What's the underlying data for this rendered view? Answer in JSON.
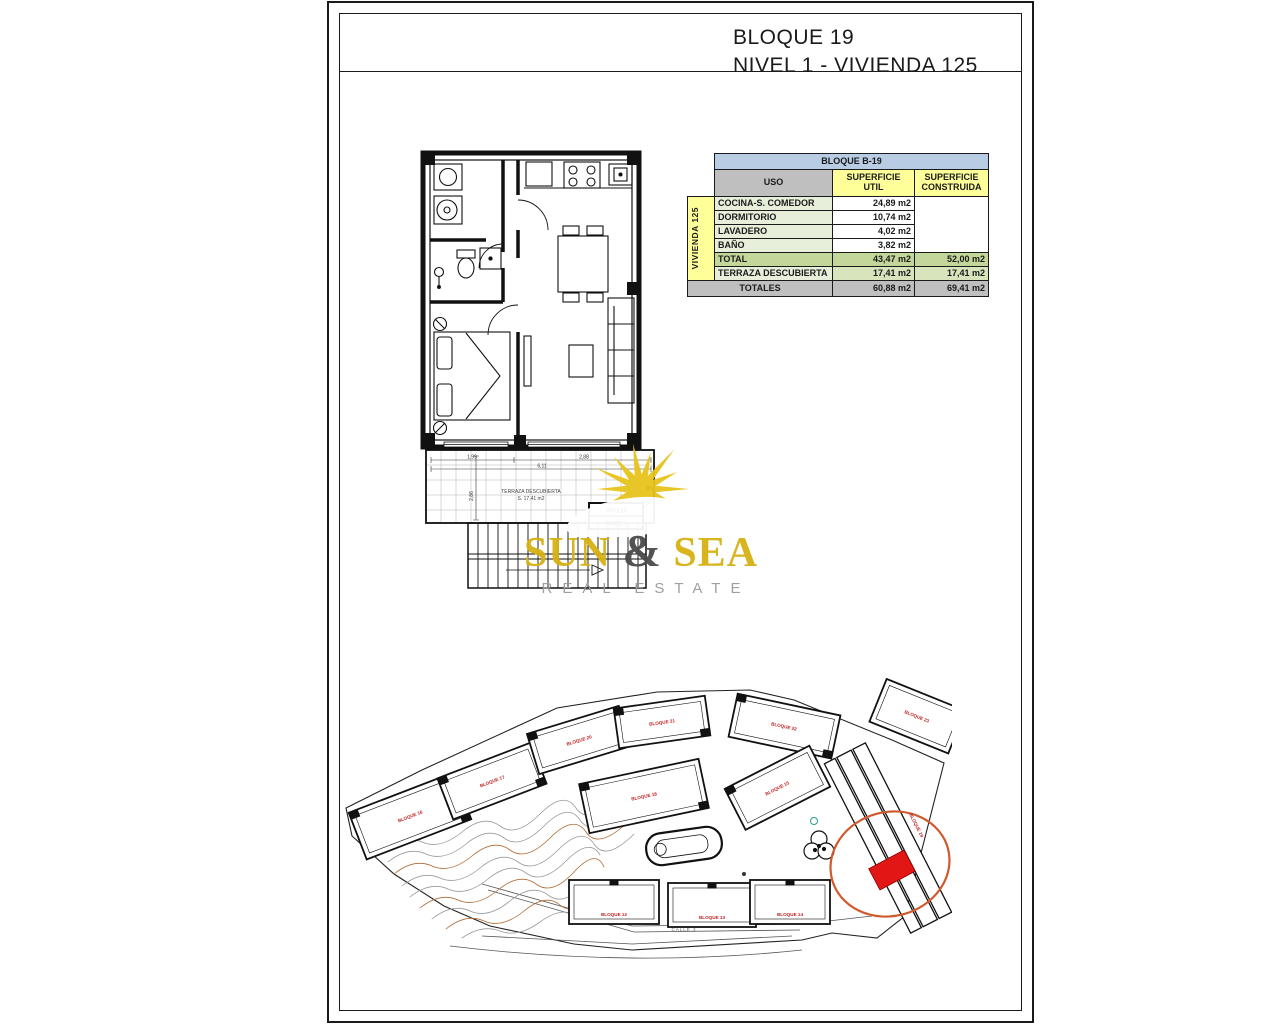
{
  "title": {
    "line1": "BLOQUE 19",
    "line2": "NIVEL 1 - VIVIENDA 125"
  },
  "areas_table": {
    "block_header": "BLOQUE B-19",
    "headers": {
      "uso": "USO",
      "util": "SUPERFICIE UTIL",
      "construida": "SUPERFICIE CONSTRUIDA"
    },
    "group_label": "VIVIENDA 125",
    "rows": [
      {
        "uso": "COCINA-S. COMEDOR",
        "util": "24,89 m2"
      },
      {
        "uso": "DORMITORIO",
        "util": "10,74 m2"
      },
      {
        "uso": "LAVADERO",
        "util": "4,02 m2"
      },
      {
        "uso": "BAÑO",
        "util": "3,82 m2"
      }
    ],
    "total_row": {
      "uso": "TOTAL",
      "util": "43,47 m2",
      "construida": "52,00 m2"
    },
    "terrace_row": {
      "uso": "TERRAZA DESCUBIERTA",
      "util": "17,41 m2",
      "construida": "17,41 m2"
    },
    "totals_row": {
      "label": "TOTALES",
      "util": "60,88 m2",
      "construida": "69,41 m2"
    }
  },
  "floor_plan": {
    "terrace_label_line1": "TERRAZA DESCUBIERTA",
    "terrace_label_line2": "S. 17,41 m2",
    "unit_tag_line1": "VIV-125",
    "unit_tag_line2": "NIVEL 1",
    "dim_left": "1,99",
    "dim_right": "2,88",
    "dim_total": "6,11",
    "dim_vertical": "2,86"
  },
  "watermark": {
    "brand_left": "SUN",
    "brand_amp": "&",
    "brand_right": "SEA",
    "tagline": "REAL ESTATE"
  },
  "site_plan": {
    "street": "CALLE 3",
    "highlight_label": "BLOQUE 19",
    "blocks": [
      "BLOQUE 16",
      "BLOQUE 17",
      "BLOQUE 20",
      "BLOQUE 21",
      "BLOQUE 22",
      "BLOQUE 23",
      "BLOQUE 18",
      "BLOQUE 15",
      "BLOQUE 12",
      "BLOQUE 13",
      "BLOQUE 14"
    ]
  },
  "colors": {
    "header_blue": "#b8cce4",
    "header_gray": "#bfbfbf",
    "header_yellow": "#ffff99",
    "row_light_green": "#e7efda",
    "total_green": "#c4d79b",
    "terrace_green": "#d7e4bc",
    "brand_gold": "#d6b214",
    "tagline_gray": "#9a9a9a",
    "highlight_red": "#e31616",
    "circle_orange": "#cf5a2d",
    "block_label_red": "#c22222",
    "contour_orange": "#b06a32",
    "contour_gray": "#9a9a9a"
  }
}
